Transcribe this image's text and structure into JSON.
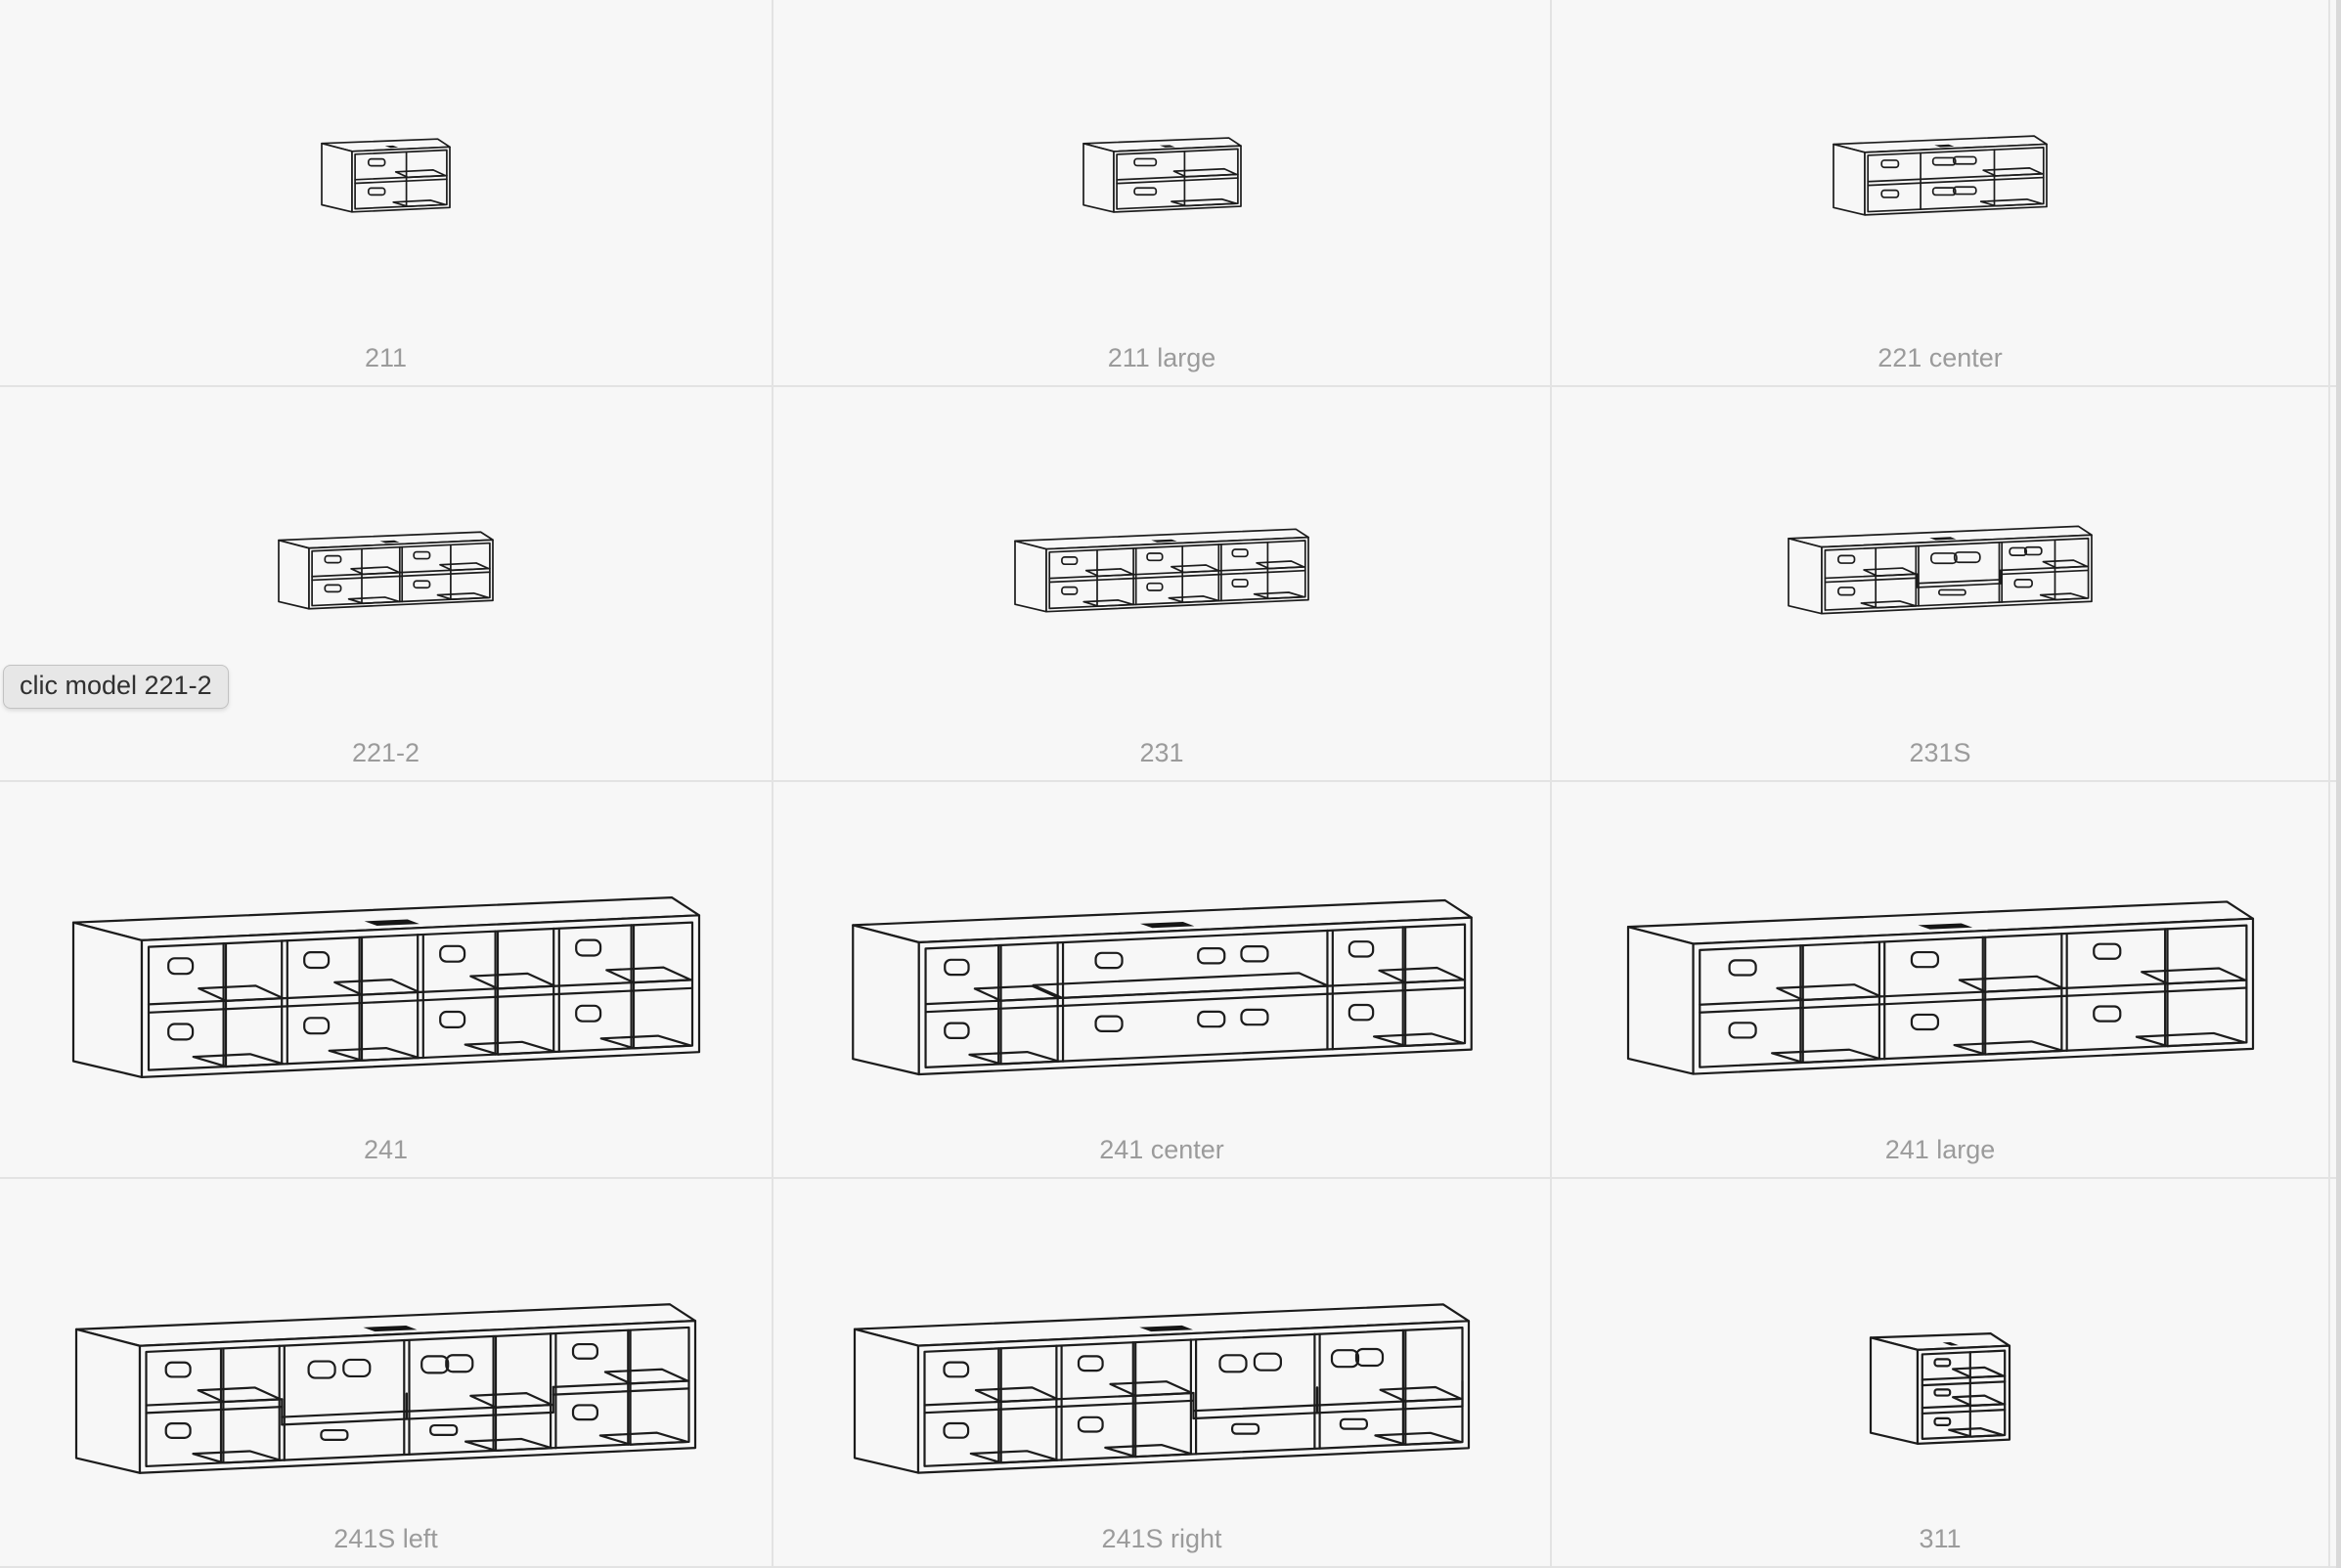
{
  "page": {
    "background": "#f7f7f7",
    "grid_line_color": "#e3e3e3",
    "label_color": "#9b9b9b",
    "drawing_line_color": "#1c1c1c"
  },
  "tooltip": {
    "text": "clic model 221-2"
  },
  "grid": {
    "items": [
      {
        "label": "211",
        "figure": "211"
      },
      {
        "label": "211 large",
        "figure": "211large"
      },
      {
        "label": "221 center",
        "figure": "221center"
      },
      {
        "label": "221-2",
        "figure": "221-2"
      },
      {
        "label": "231",
        "figure": "231"
      },
      {
        "label": "231S",
        "figure": "231S"
      },
      {
        "label": "241",
        "figure": "241"
      },
      {
        "label": "241 center",
        "figure": "241center"
      },
      {
        "label": "241 large",
        "figure": "241large"
      },
      {
        "label": "241S left",
        "figure": "241Sleft"
      },
      {
        "label": "241S right",
        "figure": "241Sright"
      },
      {
        "label": "311",
        "figure": "311"
      }
    ]
  }
}
